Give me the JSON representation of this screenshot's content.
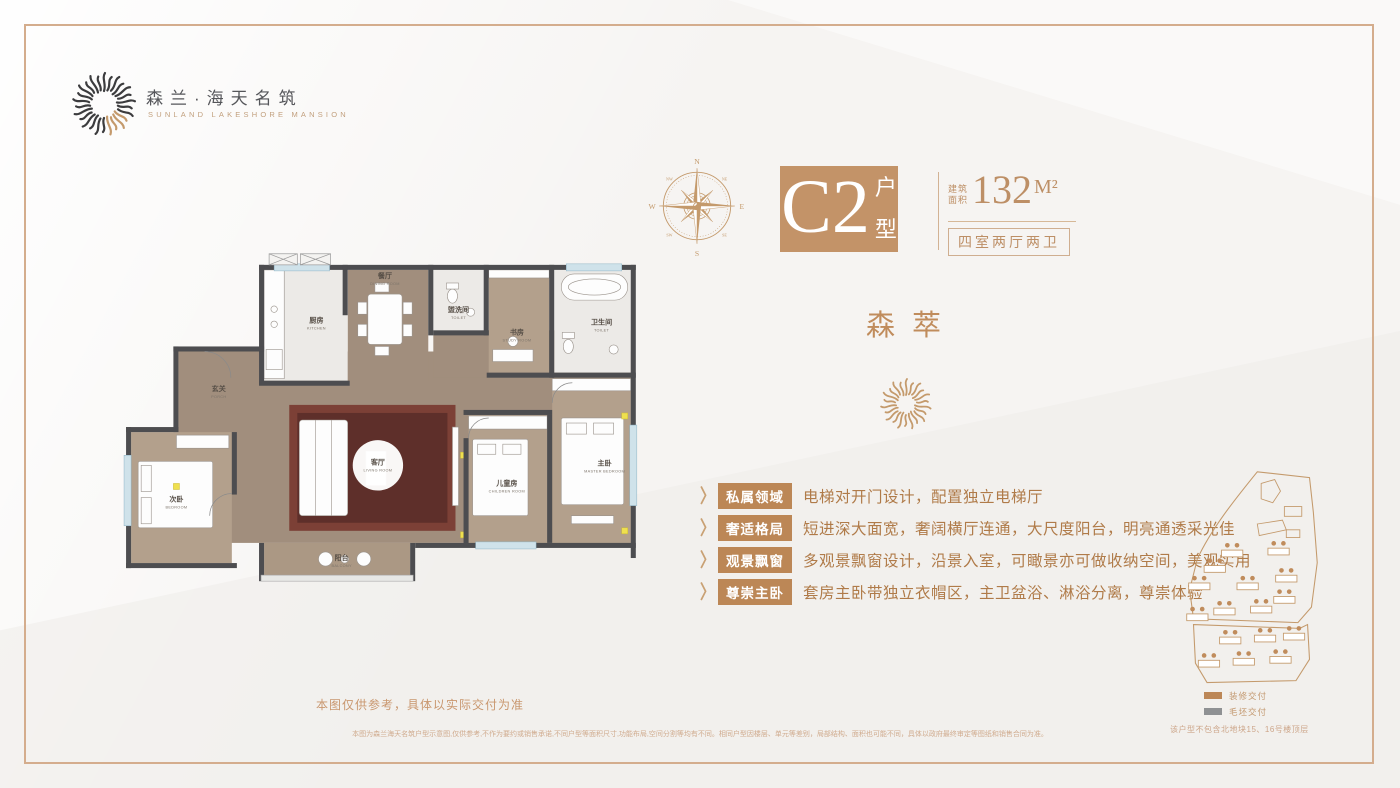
{
  "brand": {
    "name_cn": "森兰·海天名筑",
    "name_en": "SUNLAND LAKESHORE MANSION"
  },
  "compass": {
    "n": "N",
    "e": "E",
    "s": "S",
    "w": "W",
    "ne": "NE",
    "nw": "NW",
    "se": "SE",
    "sw": "SW"
  },
  "unit": {
    "code": "C2",
    "type_label_1": "户",
    "type_label_2": "型",
    "area_prefix_1": "建筑",
    "area_prefix_2": "面积",
    "area_value": "132",
    "area_unit": "M²",
    "spec": "四室两厅两卫"
  },
  "project": {
    "name": "森萃"
  },
  "features": [
    {
      "tag": "私属领域",
      "desc": "电梯对开门设计，配置独立电梯厅"
    },
    {
      "tag": "奢适格局",
      "desc": "短进深大面宽，奢阔横厅连通，大尺度阳台，明亮通透采光佳"
    },
    {
      "tag": "观景飘窗",
      "desc": "多观景飘窗设计，沿景入室，可瞰景亦可做收纳空间，美观实用"
    },
    {
      "tag": "尊崇主卧",
      "desc": "套房主卧带独立衣帽区，主卫盆浴、淋浴分离，尊崇体验"
    }
  ],
  "floorplan": {
    "rooms": [
      {
        "cn": "玄关",
        "en": "PORCH"
      },
      {
        "cn": "厨房",
        "en": "KITCHEN"
      },
      {
        "cn": "餐厅",
        "en": "DINING ROOM"
      },
      {
        "cn": "盥洗间",
        "en": "TOILET"
      },
      {
        "cn": "书房",
        "en": "STUDY ROOM"
      },
      {
        "cn": "卫生间",
        "en": "TOILET"
      },
      {
        "cn": "次卧",
        "en": "BEDROOM"
      },
      {
        "cn": "客厅",
        "en": "LIVING ROOM"
      },
      {
        "cn": "阳台",
        "en": "BALCONY"
      },
      {
        "cn": "儿童房",
        "en": "CHILDREN ROOM"
      },
      {
        "cn": "主卧",
        "en": "MASTER BEDROOM"
      }
    ],
    "note": "本图仅供参考，具体以实际交付为准"
  },
  "siteplan": {
    "legend": [
      {
        "label": "装修交付",
        "color": "#bc8757"
      },
      {
        "label": "毛坯交付",
        "color": "#8f9193"
      }
    ],
    "note": "该户型不包含北地块15、16号楼顶层"
  },
  "disclaimer": "本图为森兰海天名筑户型示意图,仅供参考,不作为要约或销售承诺,不同户型等面积尺寸,功能布局,空间分割等均有不同。相同户型因楼层、单元等差别，局部结构、面积也可能不同，具体以政府最终审定等图纸和销售合同为准。",
  "colors": {
    "accent": "#c39368",
    "tag": "#bc8756",
    "text_brown": "#b07b49",
    "wall": "#4d4d50"
  }
}
